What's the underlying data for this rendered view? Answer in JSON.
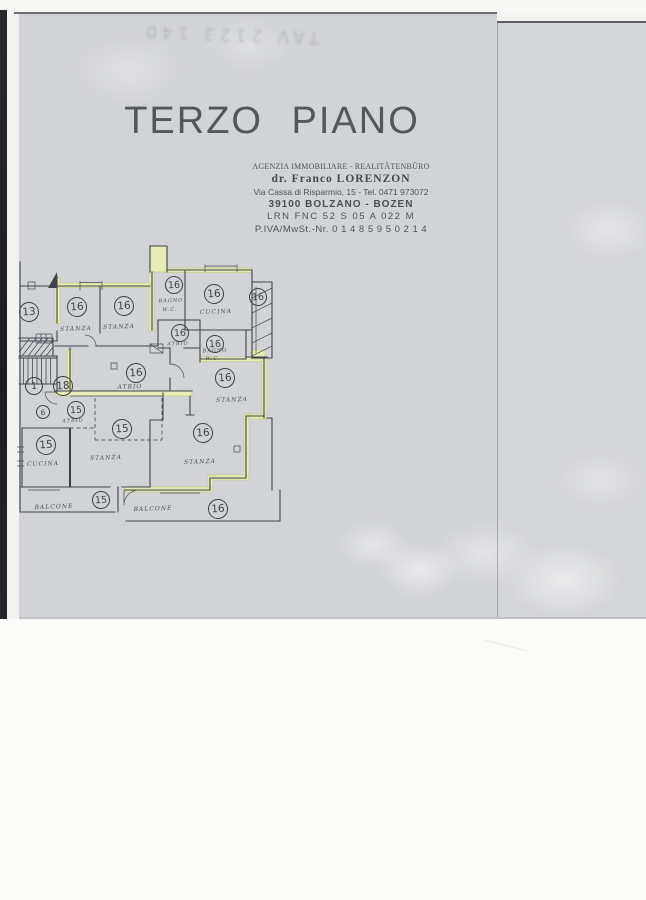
{
  "document": {
    "ghost_text": "TAV 2123 140",
    "title": "TERZO PIANO",
    "agency": {
      "type_line": "AGENZIA IMMOBILIARE - REALITÄTENBÜRO",
      "name_line": "dr. Franco LORENZON",
      "address_line": "Via Cassa di Risparmio, 15 - Tel. 0471 973072",
      "city_line": "39100 BOLZANO - BOZEN",
      "code_line": "LRN  FNC  52 S 05  A 022 M",
      "vat_line": "P.IVA/MwSt.-Nr. 0 1 4 8 5 9 5 0 2 1 4"
    }
  },
  "floorplan": {
    "units": [
      {
        "n": "13",
        "x": 28,
        "y": 311,
        "r": 9
      },
      {
        "n": "16",
        "x": 76,
        "y": 306,
        "r": 9
      },
      {
        "n": "16",
        "x": 123,
        "y": 305,
        "r": 9
      },
      {
        "n": "16",
        "x": 173,
        "y": 284,
        "r": 8
      },
      {
        "n": "16",
        "x": 213,
        "y": 293,
        "r": 9
      },
      {
        "n": "16",
        "x": 257,
        "y": 296,
        "r": 8
      },
      {
        "n": "16",
        "x": 179,
        "y": 332,
        "r": 8
      },
      {
        "n": "16",
        "x": 214,
        "y": 343,
        "r": 8
      },
      {
        "n": "16",
        "x": 135,
        "y": 372,
        "r": 9
      },
      {
        "n": "16",
        "x": 224,
        "y": 377,
        "r": 9
      },
      {
        "n": "1",
        "x": 33,
        "y": 385,
        "r": 8
      },
      {
        "n": "18",
        "x": 62,
        "y": 385,
        "r": 9
      },
      {
        "n": "15",
        "x": 75,
        "y": 409,
        "r": 8
      },
      {
        "n": "6",
        "x": 42,
        "y": 411,
        "r": 6
      },
      {
        "n": "15",
        "x": 121,
        "y": 428,
        "r": 9
      },
      {
        "n": "15",
        "x": 45,
        "y": 444,
        "r": 9
      },
      {
        "n": "16",
        "x": 202,
        "y": 432,
        "r": 9
      },
      {
        "n": "15",
        "x": 100,
        "y": 499,
        "r": 8
      },
      {
        "n": "16",
        "x": 217,
        "y": 508,
        "r": 9
      }
    ],
    "labels": [
      {
        "t": "STANZA",
        "x": 76,
        "y": 329,
        "s": 6
      },
      {
        "t": "STANZA",
        "x": 119,
        "y": 327,
        "s": 6
      },
      {
        "t": "BAGNO",
        "x": 171,
        "y": 301,
        "s": 5
      },
      {
        "t": "W.C.",
        "x": 170,
        "y": 310,
        "s": 5
      },
      {
        "t": "CUCINA",
        "x": 216,
        "y": 312,
        "s": 6
      },
      {
        "t": "ATRIO",
        "x": 178,
        "y": 344,
        "s": 5
      },
      {
        "t": "BAGNO",
        "x": 215,
        "y": 351,
        "s": 5
      },
      {
        "t": "W.C.",
        "x": 213,
        "y": 359,
        "s": 5
      },
      {
        "t": "ATRIO",
        "x": 130,
        "y": 387,
        "s": 6
      },
      {
        "t": "STANZA",
        "x": 232,
        "y": 400,
        "s": 6
      },
      {
        "t": "ATRIO",
        "x": 73,
        "y": 421,
        "s": 5
      },
      {
        "t": "STANZA",
        "x": 106,
        "y": 458,
        "s": 6
      },
      {
        "t": "CUCINA",
        "x": 43,
        "y": 464,
        "s": 6
      },
      {
        "t": "STANZA",
        "x": 200,
        "y": 462,
        "s": 6
      },
      {
        "t": "BALCONE",
        "x": 54,
        "y": 507,
        "s": 6
      },
      {
        "t": "BALCONE",
        "x": 153,
        "y": 509,
        "s": 6
      }
    ]
  },
  "colors": {
    "paper": "#d2d3d6",
    "wall_line": "#3f434b",
    "highlight": "#e8ecb6",
    "page_bottom": "#fbfbf9"
  }
}
